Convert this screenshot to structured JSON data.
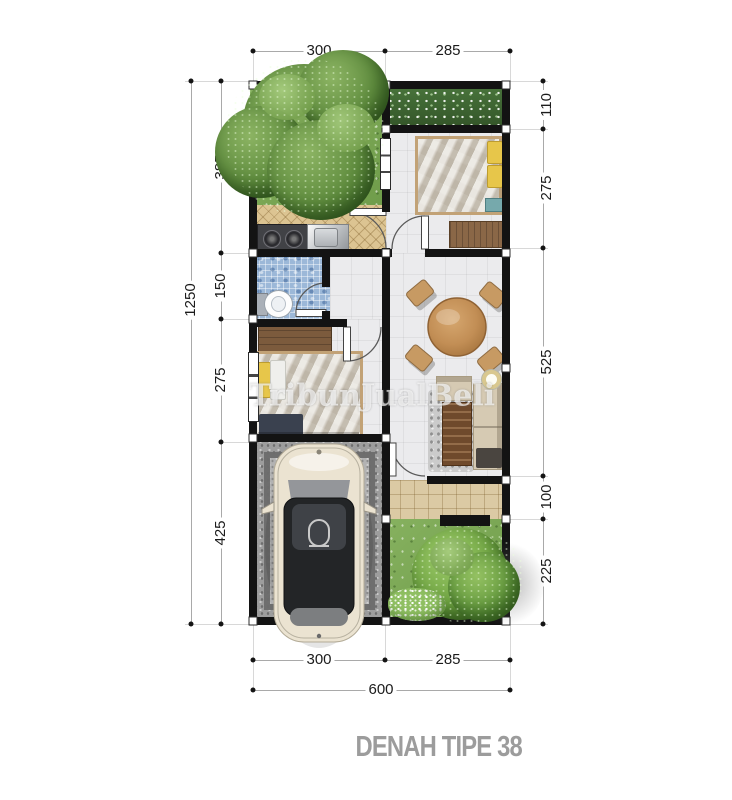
{
  "title": "DENAH TIPE 38",
  "watermark": "TribunJualBeli",
  "dims": {
    "top": [
      "300",
      "285"
    ],
    "right": [
      "110",
      "275",
      "525",
      "100",
      "225"
    ],
    "left": [
      "385",
      "150",
      "275",
      "425"
    ],
    "left_total": "1250",
    "bottom": [
      "300",
      "285"
    ],
    "bottom_total": "600"
  },
  "colors": {
    "wall": "#131313",
    "grass": "#7aa655",
    "hedge": "#3e6530",
    "kitchen_floor": "#dcc492",
    "bathroom_tile": "#9cb8d8",
    "carport_gravel": "#9d9d9d",
    "terrace_tile": "#dbcaa4",
    "table_wood": "#c28e55",
    "title_text": "#9c9c9c"
  }
}
